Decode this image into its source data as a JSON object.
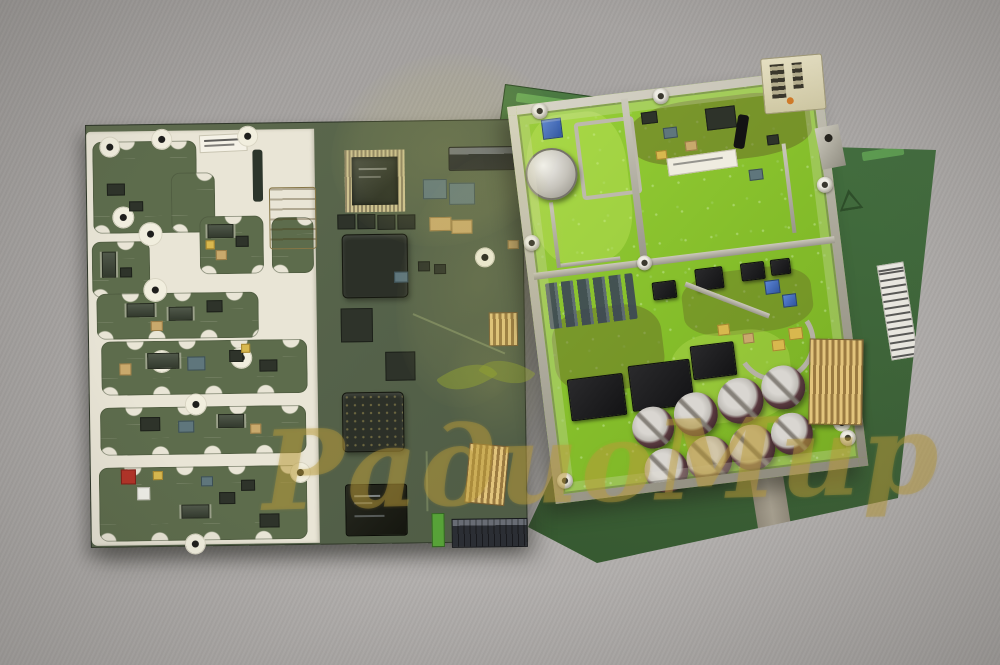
{
  "scene": {
    "title": "Photograph of disassembled green printed circuit boards on gray fabric",
    "background_color": "#a8a5a3",
    "watermark": {
      "text": "РадиоМир",
      "color": "#ba9c3a",
      "emblem": "leaf-sprout-swoosh"
    },
    "boards": {
      "main_board": {
        "name": "baseband-board",
        "solder_mask_color": "#5c6a4b",
        "silkscreen_color": "#e9e5d6",
        "features": [
          "white shield-frame compartments",
          "QFP chip",
          "BGA chips",
          "SIM connector",
          "gold edge connectors",
          "red component",
          "white serial label"
        ]
      },
      "rf_module": {
        "name": "rf-shield-module",
        "solder_mask_color": "#8cc42e",
        "frame_color": "#b9b5a8",
        "electrolytic_capacitor_count": 8,
        "features": [
          "metal shield frame",
          "crystal can",
          "blue component",
          "cream connector",
          "gold comb connector",
          "white label"
        ]
      },
      "back_board": {
        "name": "backing-board",
        "solder_mask_color": "#41673c",
        "features": [
          "white barcode label",
          "triangle mark",
          "bare metal stripe",
          "green barcode mark"
        ]
      }
    }
  }
}
